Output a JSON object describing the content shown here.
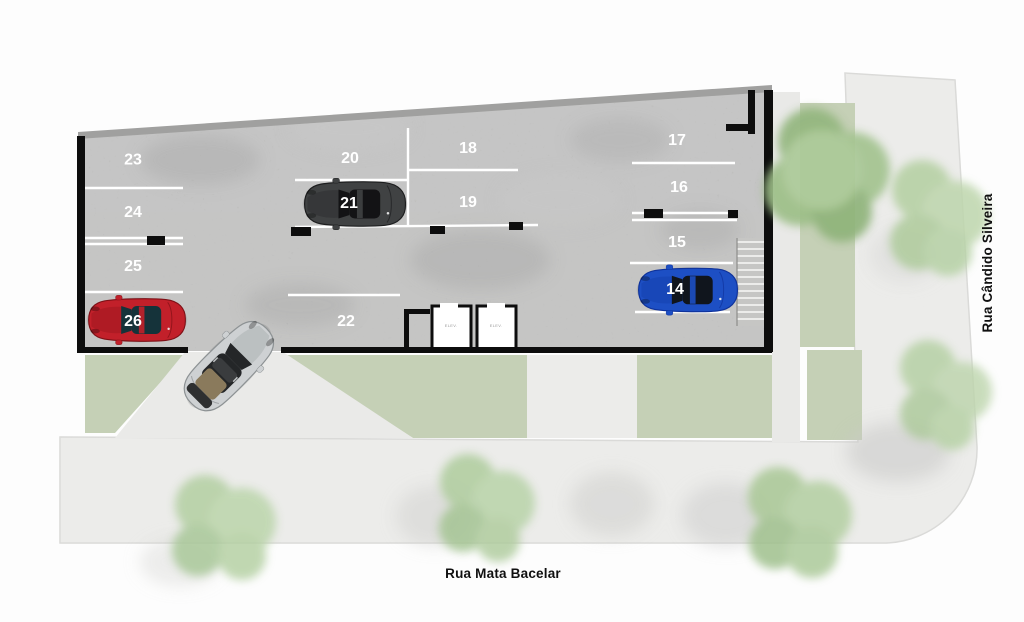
{
  "streets": {
    "bottom": "Rua Mata Bacelar",
    "right": "Rua Cândido Silveira"
  },
  "spot_labels": {
    "14": "14",
    "15": "15",
    "16": "16",
    "17": "17",
    "18": "18",
    "19": "19",
    "20": "20",
    "21": "21",
    "22": "22",
    "23": "23",
    "24": "24",
    "25": "25",
    "26": "26"
  },
  "elevators": {
    "left_label": "ELEV.",
    "right_label": "ELEV."
  },
  "cars": {
    "red": {
      "name": "red sports car parked in spot 26",
      "palette": "--body:#c2202a;--shade:#7e1016;--glass:#15333a"
    },
    "dark": {
      "name": "dark grey sports car in spot 21",
      "palette": "--body:#404243;--shade:#1d1e1f;--glass:#131315"
    },
    "blue": {
      "name": "blue sports car parked in spot 14",
      "palette": "--body:#1d4fc4;--shade:#0f329b;--glass:#10151d"
    },
    "silver": {
      "name": "silver convertible entering ramp",
      "palette": "--body:#ced1d3;--shade:#8d9294;--glass:#242628"
    }
  },
  "colors": {
    "grass": "#c5d0b6",
    "sidewalk": "#ececea",
    "driveway": "#eaeae8",
    "garage_floor": "#b4b4b3",
    "slab_edge": "#a0a09f",
    "wall": "#0d0d0d",
    "stall_line": "#ffffff",
    "stair": "#c6c6c4"
  }
}
